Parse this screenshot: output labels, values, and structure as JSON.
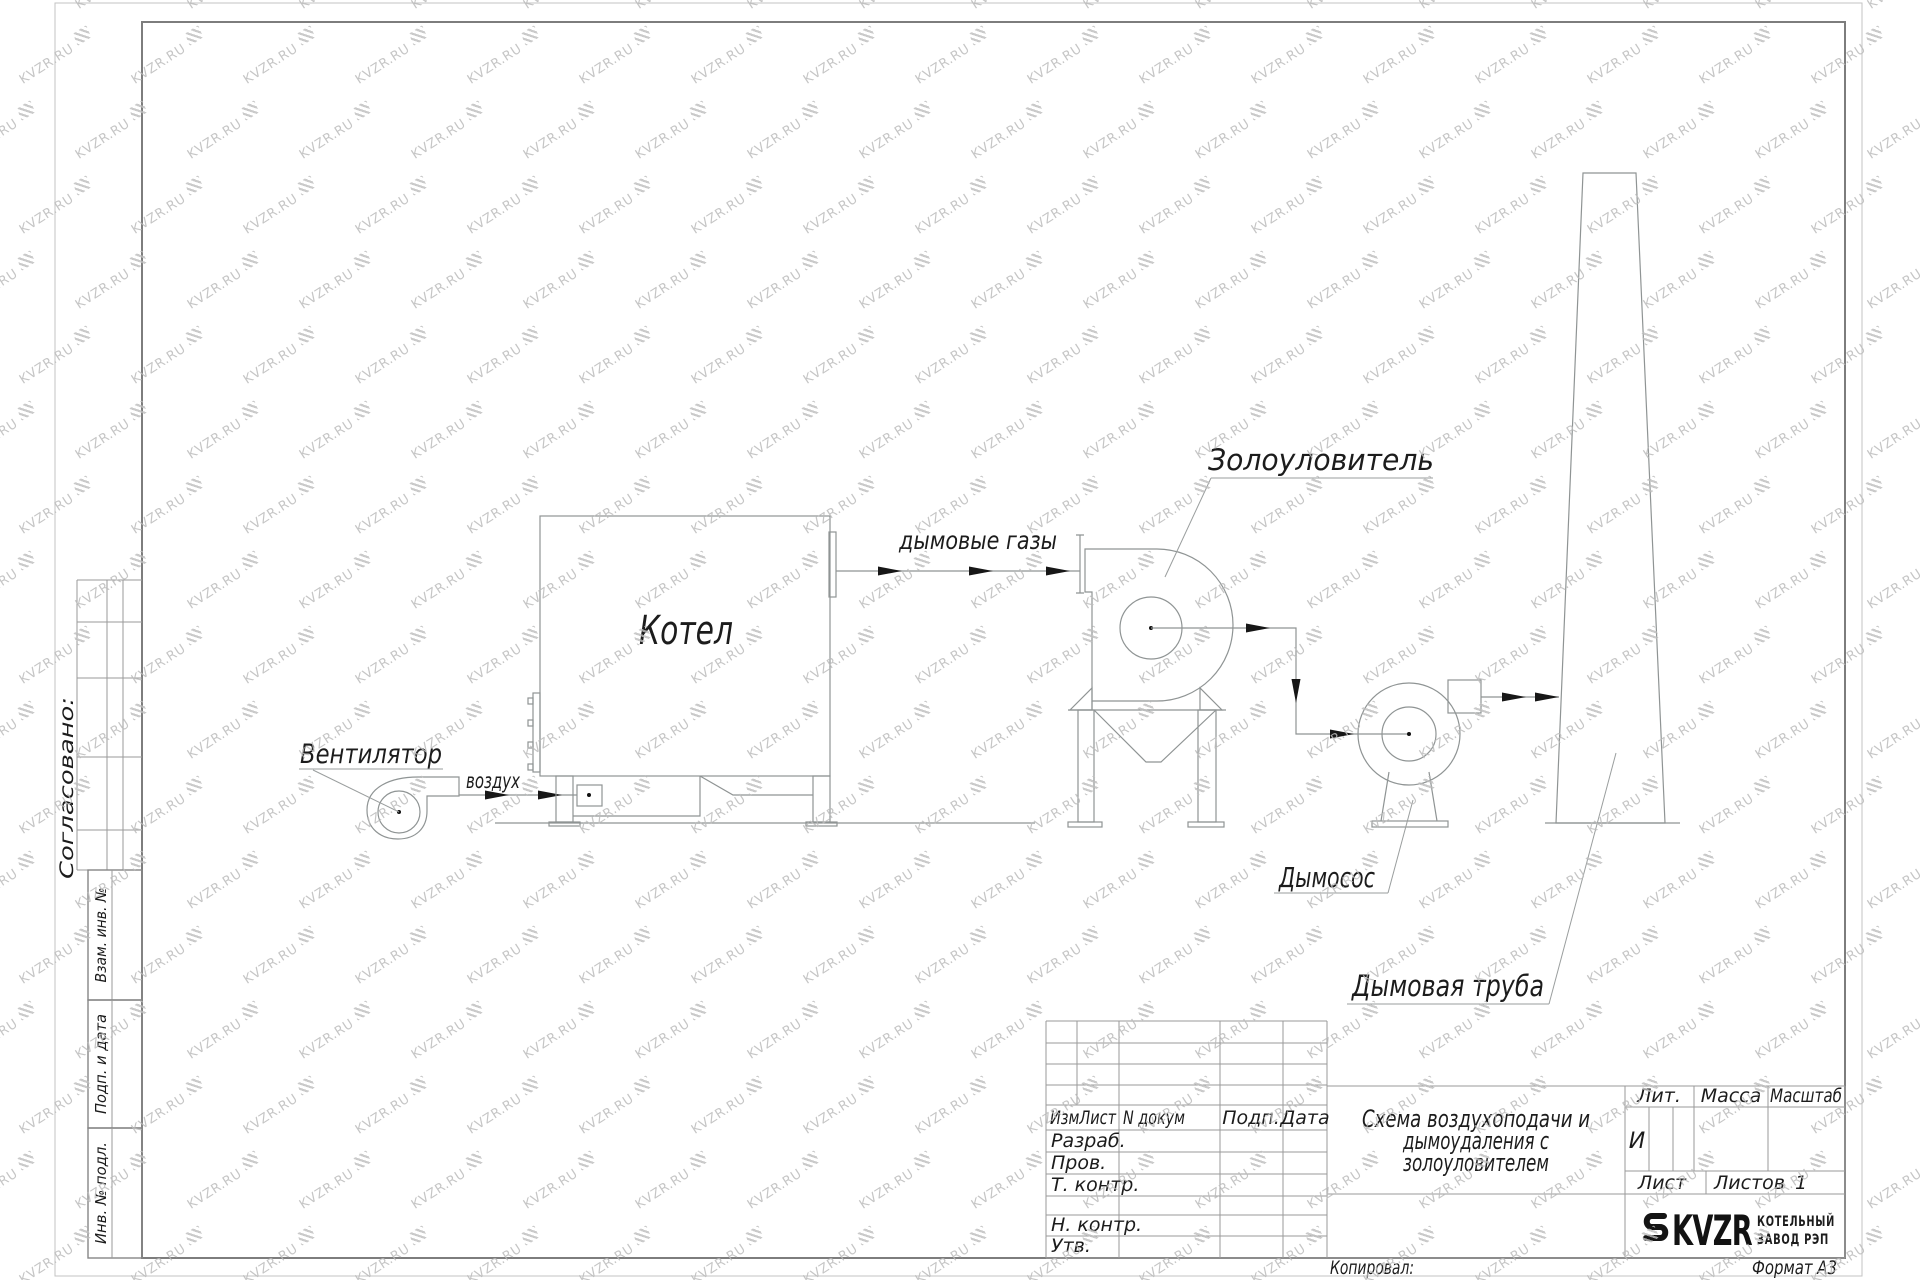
{
  "watermark": {
    "text": "KVZR.RU",
    "icon": "hatch-coil-icon"
  },
  "left_margin": {
    "approved_label": "Согласовано:",
    "vzam_inv_label": "Взам. инв. №",
    "podp_data_label": "Подп. и дата",
    "inv_podl_label": "Инв. № подл."
  },
  "diagram": {
    "labels": {
      "fan": "Вентилятор",
      "air": "воздух",
      "boiler": "Котел",
      "flue_gases": "дымовые газы",
      "ash_collector": "Золоуловитель",
      "smoke_exhauster": "Дымосос",
      "chimney": "Дымовая труба"
    }
  },
  "title_block": {
    "change_header": {
      "izm_list": "ИзмЛист",
      "n_dokum": "N докум",
      "podp": "Подп.",
      "data": "Дата"
    },
    "roles": [
      "Разраб.",
      "Пров.",
      "Т. контр.",
      "Н. контр.",
      "Утв."
    ],
    "title_lines": [
      "Схема воздухоподачи и",
      "дымоудаления с",
      "золоуловителем"
    ],
    "lit_label": "Лит.",
    "lit_value": "И",
    "massa_label": "Масса",
    "masshtab_label": "Масштаб",
    "list_label": "Лист",
    "listov_label": "Листов",
    "listov_value": "1",
    "logo": {
      "icon": "coil-icon",
      "brand": "KVZR",
      "line1": "КОТЕЛЬНЫЙ",
      "line2": "ЗАВОД РЭП"
    },
    "kopiroval_label": "Копировал:",
    "format_label": "Формат А3"
  }
}
